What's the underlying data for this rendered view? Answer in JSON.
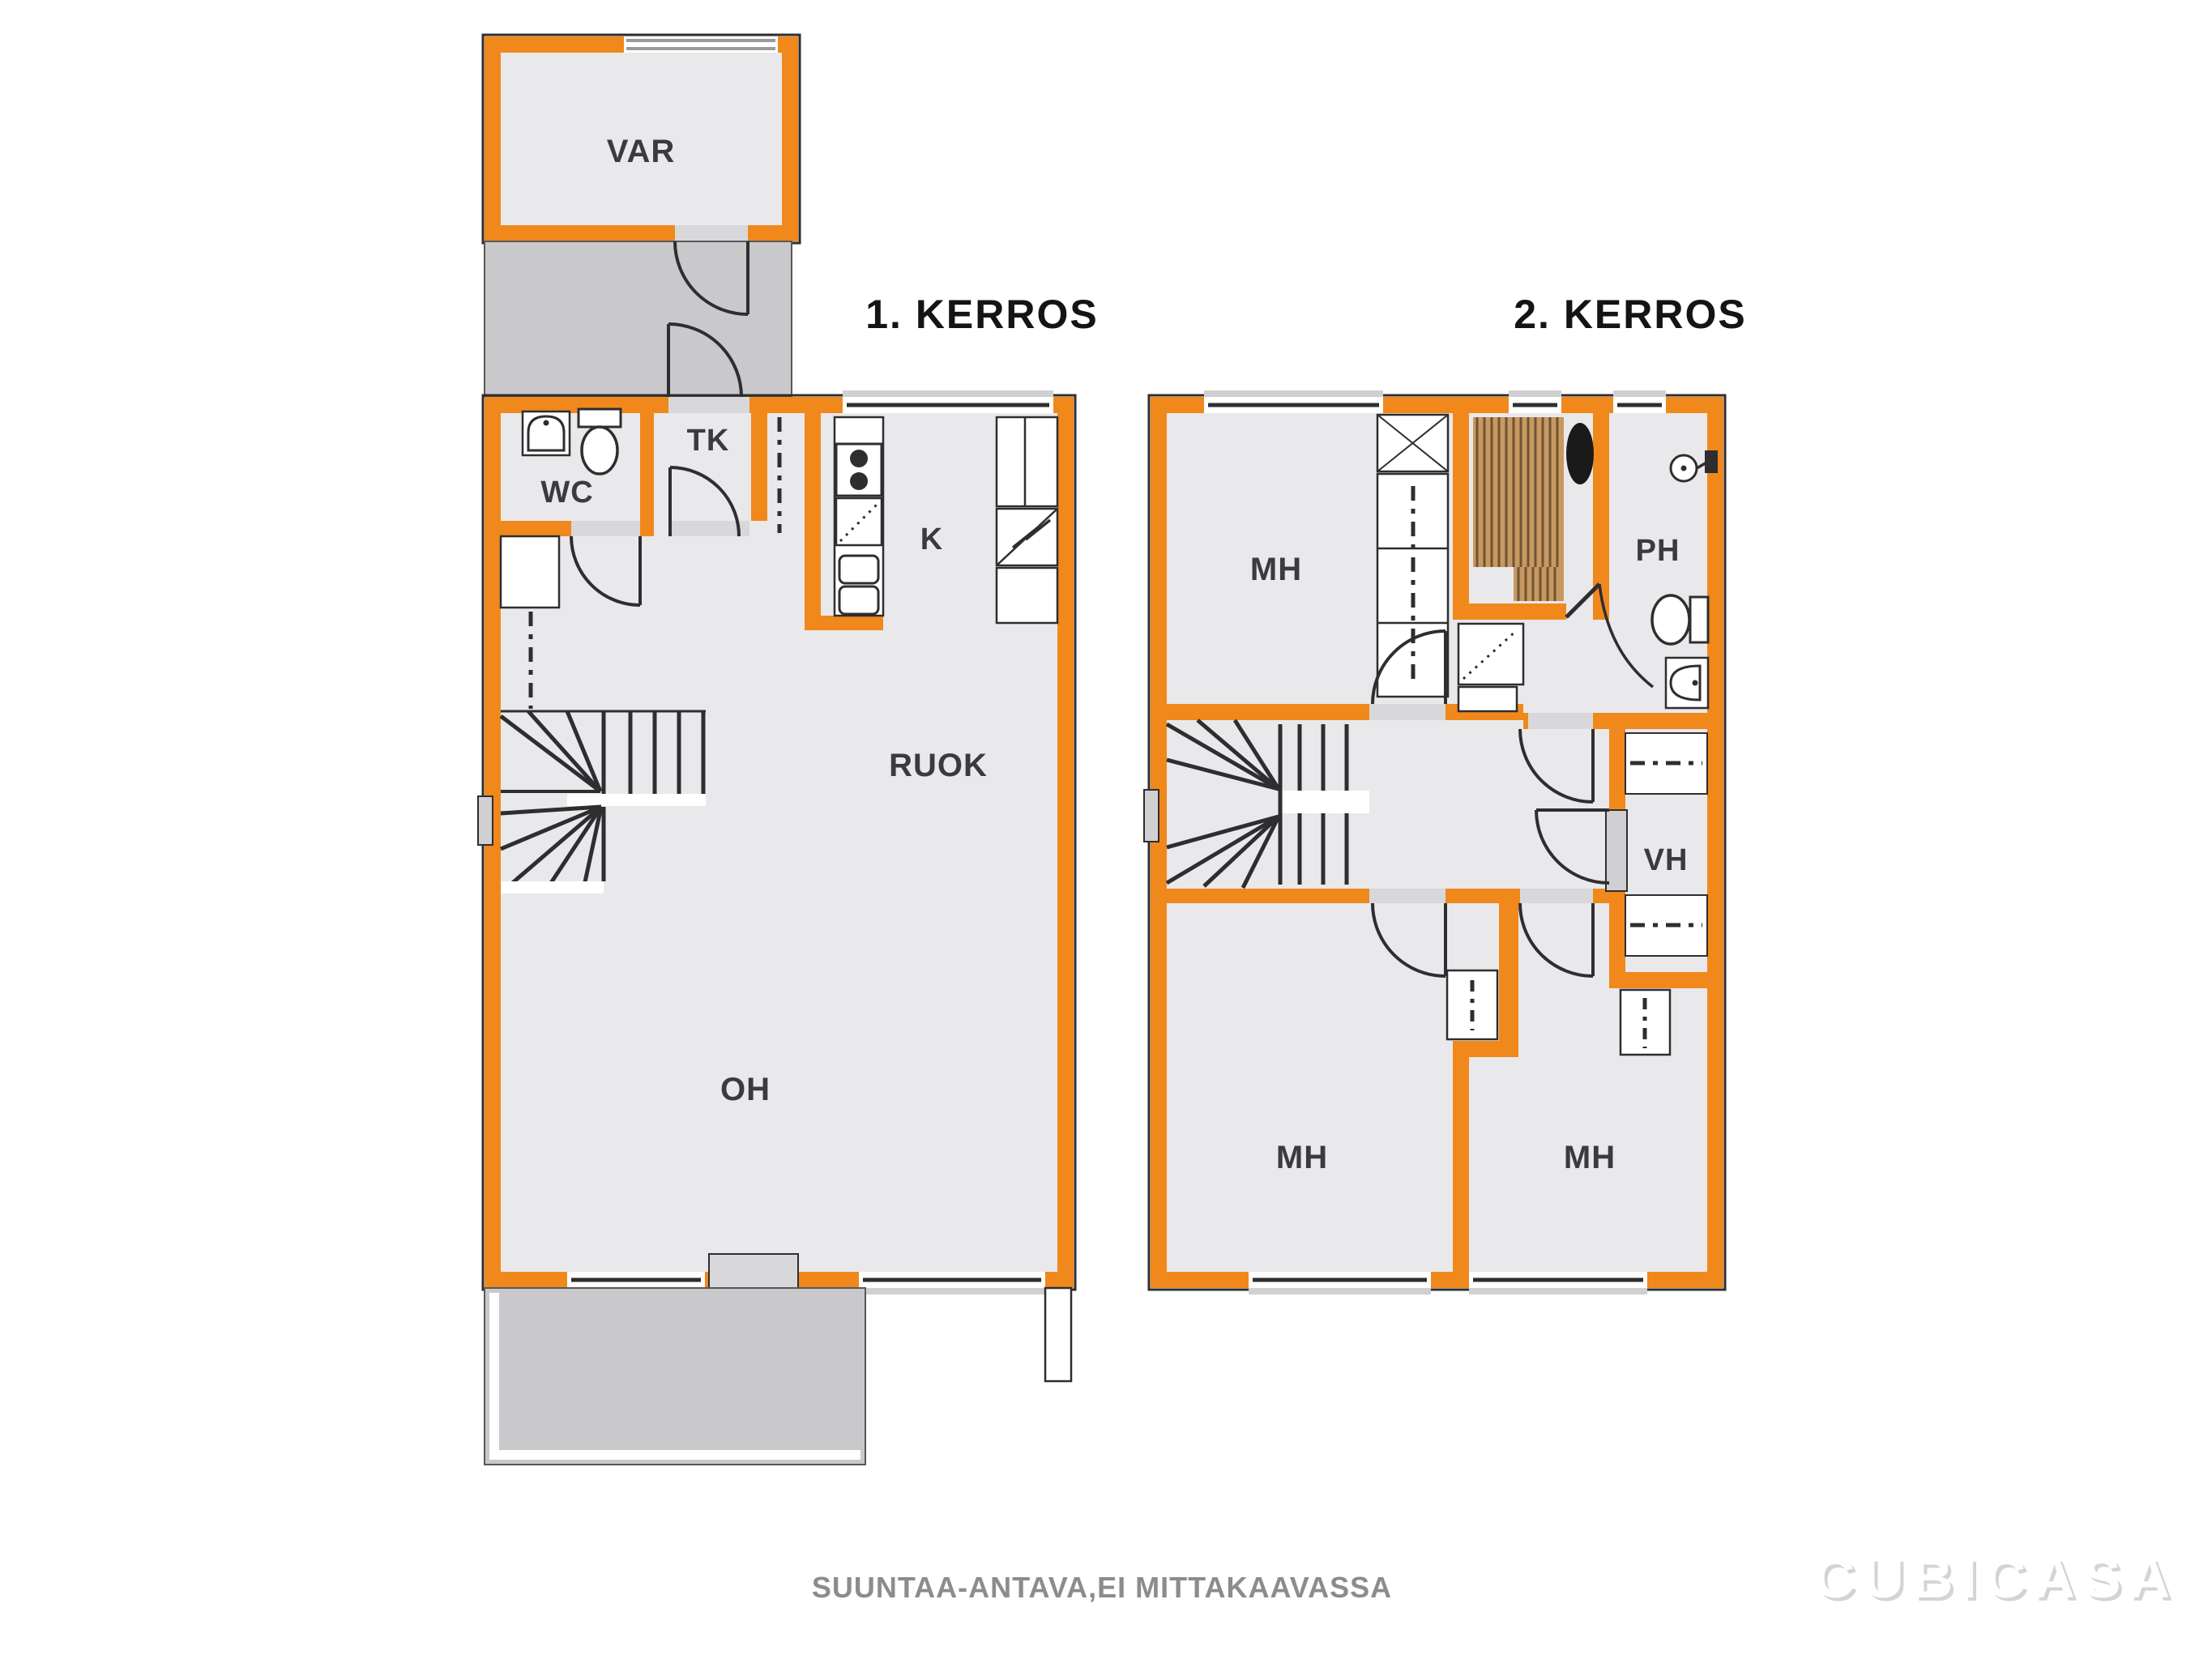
{
  "floor1": {
    "title": "1. KERROS",
    "rooms": {
      "var": "VAR",
      "wc": "WC",
      "tk": "TK",
      "k": "K",
      "ruok": "RUOK",
      "oh": "OH"
    }
  },
  "floor2": {
    "title": "2. KERROS",
    "rooms": {
      "mh_top": "MH",
      "ph": "PH",
      "vh": "VH",
      "mh_bottom_left": "MH",
      "mh_bottom_right": "MH"
    }
  },
  "footer": {
    "note": "SUUNTAA-ANTAVA,EI MITTAKAAVASSA",
    "logo": "CUBICASA"
  },
  "icons": [
    "toilet-icon",
    "sink-icon",
    "shower-icon",
    "stove-icon",
    "dishwasher-icon",
    "fridge-icon",
    "freezer-icon",
    "sauna-stove-icon",
    "washer-icon",
    "wardrobe-icon",
    "stairs-icon",
    "door-arc-icon",
    "window-icon"
  ],
  "colors": {
    "wall_orange": "#F1881C",
    "room_fill": "#E9E9EB",
    "outdoor_fill": "#C9C9CB",
    "opening_fill": "#D8D8DA",
    "sill_fill": "#D0D0D2",
    "wood": "#C79961",
    "wood_line": "#6F5434",
    "outline": "#2E2E30",
    "label_text": "#3B3B3D",
    "note_text": "#8C8C8E"
  }
}
